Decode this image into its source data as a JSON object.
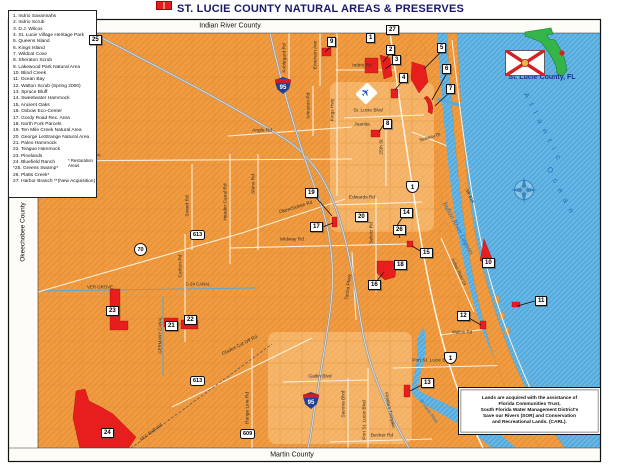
{
  "title": "ST. LUCIE COUNTY NATURAL AREAS & PRESERVES",
  "counties": {
    "north": "Indian River County",
    "south": "Martin County",
    "west": "Okeechobee County"
  },
  "locator": {
    "label": "St. Lucie County, FL"
  },
  "legend": {
    "items": [
      "1.  Indrio Savannahs",
      "2.  Indrio Scrub",
      "3.  D.J. Wilcox",
      "4.  St. Lucie Village Heritage Park",
      "5.  Queens Island",
      "6.  Kings Island",
      "7.  Wildcat Cove",
      "8.  Sheraton Scrub",
      "9.  Lakewood Park Natural Area",
      "10. Blind Creek",
      "11. Ocean Bay",
      "12. Walton Scrub (Spring 2000)",
      "13. Spruce Bluff",
      "14. Sweetwater Hammock",
      "15. Ancient Oaks",
      "16. Oxbow Eco-Center",
      "17. Gordy Road Rec. Area",
      "18. North Fork Parcels",
      "19. Ten Mile Creek Natural Area",
      "20. George LeStrange Natural Area",
      "21. Paleo Hammock",
      "22. Teague Hammock",
      "23. Pinelands",
      "24. Bluefield Ranch",
      "*25. Greens Swamp*",
      "26. Platts Creek*",
      "27. Harbor Branch **(New Acquisition)"
    ],
    "note": "* Restoration Areas"
  },
  "credits": {
    "l1": "Lands are acquired with the assistance of",
    "l2": "Florida Communities Trust,",
    "l3": "South Florida Water Management District's",
    "l4": "Save our Rivers (SOR) and Conservation",
    "l5": "and Recreational Lands. (CARL)."
  },
  "water_labels": {
    "atlantic_1": "A t l a n t i c",
    "atlantic_2": "O c e a n",
    "lagoon": "Indian River Lagoon",
    "river": "St. Lucie River",
    "c24": "C-24 CANAL",
    "germany": "GERMANY CANAL"
  },
  "roads": {
    "indrio": "Indrio Rd",
    "angle": "Angle Rd",
    "st_lucie_blvd": "St. Lucie Blvd",
    "orange": "Orange Ave",
    "okeechobee": "Okeechobee Rd",
    "edwards": "Edwards Rd",
    "midway": "Midway Rd",
    "walton": "Walton Rd",
    "psl_blvd": "Port St. Lucie Blvd",
    "gatlin": "Gatlin Blvd",
    "becker": "Becker Rd",
    "glades": "Glades Cut Off Rd",
    "range_line": "Range Line Rd",
    "carlton": "Carlton Rd",
    "shinn": "Shinn Rd",
    "header_canal": "Header Canal Rd",
    "sneed": "Sneed Rd",
    "kings": "Kings Hwy",
    "emerson": "Emerson Ave",
    "koblegard": "Koblegard Rd",
    "johnston": "Johnston Rd",
    "selvitz": "Selvitz Rd",
    "st25": "25th St",
    "savona": "Savona Blvd",
    "torino": "Torino Pkwy",
    "seaway": "Seaway Dr",
    "indian_river_dr": "Indian River Dr",
    "turnpike": "Florida's Turnpike",
    "sr_a1a": "SR A1A",
    "fec": "FEC Railroad"
  },
  "places": {
    "juanita": "Juanita",
    "ver_grove": "VER GROVE"
  },
  "markers": {
    "m1": "1",
    "m2": "2",
    "m3": "3",
    "m4": "4",
    "m5": "5",
    "m6": "6",
    "m7": "7",
    "m8": "8",
    "m9": "9",
    "m10": "10",
    "m11": "11",
    "m12": "12",
    "m13": "13",
    "m14": "14",
    "m15": "15",
    "m16": "16",
    "m17": "17",
    "m18": "18",
    "m19": "19",
    "m20": "20",
    "m21": "21",
    "m22": "22",
    "m23": "23",
    "m24": "24",
    "m25": "25",
    "m26": "26",
    "m27": "27"
  },
  "shields": {
    "i95": "95",
    "us1": "1",
    "sr70": "70",
    "sr613": "613",
    "sr609": "609"
  },
  "icons": {
    "airport": "✈"
  },
  "colors": {
    "land": "#F19C42",
    "water": "#55ABDD",
    "preserve_red": "#E81E1E",
    "highway_gray": "#9C9C9C",
    "title_navy": "#18186B"
  }
}
